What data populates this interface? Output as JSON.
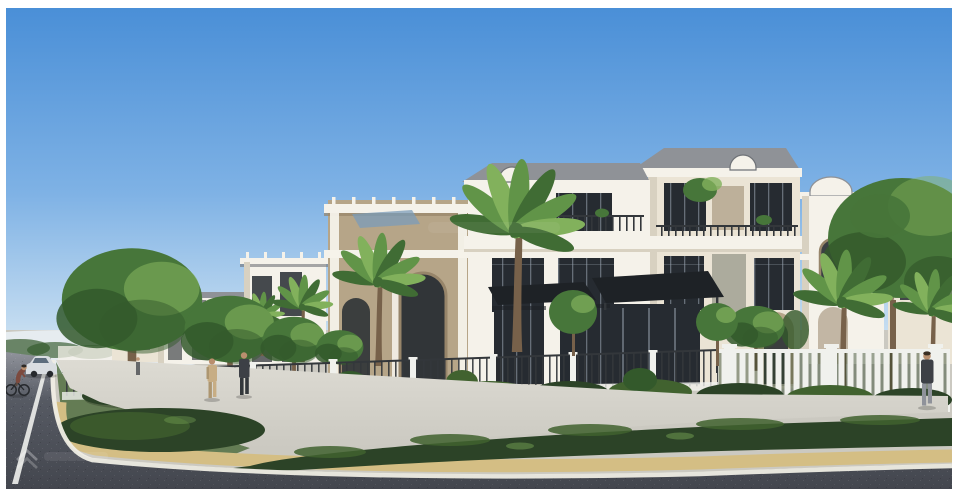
{
  "meta": {
    "title": "3D architectural render of a white villa development at a street corner",
    "canvas": {
      "width": 960,
      "height": 492
    },
    "style": "photorealistic exterior visualization, clear daylight",
    "frame": "thin white border around photo"
  },
  "palette": {
    "frame-white": "#ffffff",
    "sky-top": "#4a8fd7",
    "sky-mid": "#7fb2e5",
    "sky-low": "#c2dbf0",
    "haze-white": "#e9f0f5",
    "road-far": "#90939b",
    "road-mid": "#565a63",
    "road-dark": "#43464e",
    "lane-white": "#eef0ec",
    "curb-white": "#efede4",
    "tan-curb": "#d4be84",
    "tan-curb-dark": "#bda671",
    "sidewalk": "#cbc9c1",
    "sidewalk-light": "#dddbd3",
    "hedge-dark": "#2c4327",
    "hedge-mid": "#41622f",
    "leaf-light": "#82b15c",
    "tree-green": "#47763a",
    "tree-dark": "#33592b",
    "palm-green": "#619448",
    "palm-dark": "#406c34",
    "trunk-brown": "#77614a",
    "villa-white": "#f5f2ea",
    "villa-cream": "#ebe4d5",
    "villa-shade": "#d8d1c1",
    "stone": "#b6a588",
    "stone-dark": "#97856a",
    "window-dark": "#262b31",
    "glass-blue": "#47596b",
    "mullion": "#9aa6b2",
    "roof-gray": "#8f9297",
    "roof-dark": "#6f7277",
    "canopy-black": "#1e2226",
    "rail-dark": "#33373b",
    "fence-white": "#f0f1ed",
    "pergola-blue": "#7b9cba",
    "person-beige": "#c7ad84",
    "person-beige-dark": "#ad9670",
    "person-dark": "#3d4046",
    "person-gray": "#8f929a",
    "skin": "#b98f6e",
    "rider-maroon": "#7c4a3e",
    "car-white": "#d9dde1",
    "wheel-dark": "#26292d",
    "shadow-soft": "#00000033",
    "watermark-white": "#ffffff"
  },
  "scene": {
    "sky": {
      "label": "clear blue sky fading to pale horizon"
    },
    "buildings": {
      "main_villa": {
        "label": "three-storey white neoclassical villa",
        "features": [
          "grey hip roofs",
          "arched dormer caps",
          "white cornice band",
          "dark aluminium-framed windows",
          "balcony railings with plants",
          "two black entrance canopies",
          "dark glass entry doors",
          "stone side arch"
        ]
      },
      "left_row": {
        "label": "receding villas with rooftop pergolas, blue glass canopy and stone arched porch"
      },
      "right_row": {
        "label": "receding arch-fronted villas behind palms"
      }
    },
    "landscape": {
      "street_trees": 5,
      "palms": 6,
      "big_right_tree": "dark green canopy tree at right edge",
      "hedges": [
        "corner island hedge",
        "foreground hedge strip"
      ],
      "ornamental_trees": 2,
      "front_garden": "low shrubs along the fence line"
    },
    "street": {
      "left_road": "asphalt road receding to the left with white lane line",
      "bottom_road": "asphalt road across the foreground",
      "curb": "white painted curb line",
      "kerb_band": "sandstone kerb band",
      "sidewalk": "light concrete corner walkway"
    },
    "fence": {
      "left_section": "white piers with dark metal railings",
      "right_section": "tall white picket fence"
    },
    "figures": {
      "pedestrian_pair": [
        "person in beige outfit",
        "person in dark suit"
      ],
      "right_walker": "person in dark jacket and grey trousers",
      "distant_pedestrian": "small figure near far fence",
      "cyclist": "cyclist in maroon shirt on left road",
      "vehicle": "white car on left road"
    },
    "watermark": {
      "icon": "double-chevron-watermark-icon",
      "position": "bottom-left",
      "opacity": 0.25
    }
  }
}
